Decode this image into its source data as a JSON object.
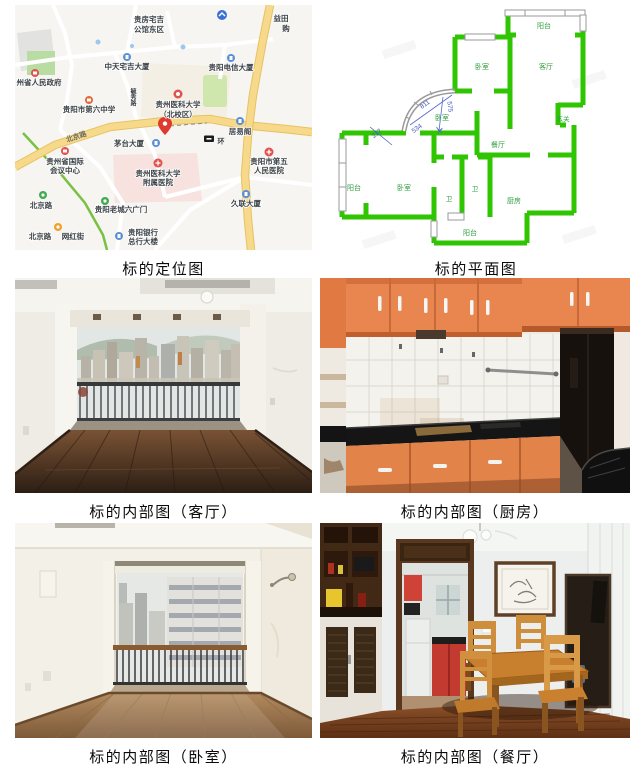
{
  "captions": {
    "map": "标的定位图",
    "floorplan": "标的平面图",
    "living": "标的内部图（客厅）",
    "kitchen": "标的内部图（厨房）",
    "bedroom": "标的内部图（卧室）",
    "dining": "标的内部图（餐厅）"
  },
  "map": {
    "labels": {
      "estate_l1": "贵房宅吉",
      "estate_l2": "公馆东区",
      "zhongtian": "中天宅吉大厦",
      "telecom": "贵阳电信大厦",
      "yitian_l1": "益田",
      "yitian_l2": "购",
      "gov": "州省人民政府",
      "school6": "贵阳市第六中学",
      "street_v": "毓秀路",
      "meduniv_l1": "贵州医科大学",
      "meduniv_l2": "（北校区）",
      "juyige": "居易阁",
      "maotai": "茅台大厦",
      "ring": "环",
      "road_beijing": "北京路",
      "conf_l1": "贵州省国际",
      "conf_l2": "会议中心",
      "affhosp_l1": "贵州医科大学",
      "affhosp_l2": "附属医院",
      "hosp5_l1": "贵阳市第五",
      "hosp5_l2": "人民医院",
      "metro_beijing": "北京路",
      "liuguangmen": "贵阳老城六广门",
      "wanghong_a": "北京路",
      "wanghong_b": "网红街",
      "bank_l1": "贵阳银行",
      "bank_l2": "总行大楼",
      "julian": "久联大厦"
    },
    "colors": {
      "road_main": "#f7d98c",
      "park": "#cfe6ad",
      "poi_red": "#e0524e",
      "poi_blue": "#5a8fd6",
      "pin": "#de3a2e"
    }
  },
  "floorplan": {
    "rooms": {
      "balcony_top": "阳台",
      "bedroom_top": "卧室",
      "living": "客厅",
      "foyer": "玄关",
      "bedroom_mid": "卧室",
      "dining": "餐厅",
      "balcony_left": "阳台",
      "bedroom_left": "卧室",
      "bath1": "卫",
      "bath2": "卫",
      "kitchen": "厨房",
      "balcony_bottom": "阳台"
    },
    "dims": {
      "d1": "811",
      "d2": "575",
      "d3": "534",
      "d4": "217"
    },
    "wall_color": "#2fc500"
  }
}
